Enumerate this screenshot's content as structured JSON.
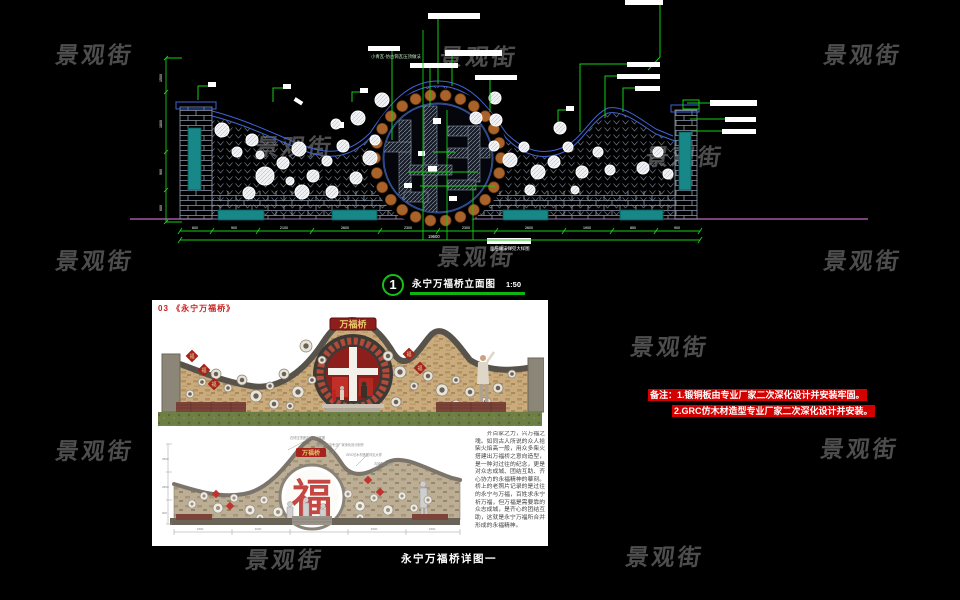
{
  "watermark": {
    "text": "景观街"
  },
  "cad": {
    "annotation_top": "小青瓦-仿古筒瓦压顶做法",
    "annotation_bottom": "面层做法详见大样图",
    "dim_overall": "19600",
    "dims_bottom": [
      "600",
      "900",
      "2100",
      "2600",
      "2300",
      "2300",
      "2600",
      "1900",
      "850",
      "900"
    ],
    "dims_left": [
      "1500",
      "1800",
      "900",
      "600"
    ]
  },
  "drawing_title": {
    "number": "1",
    "label": "永宁万福桥立面图",
    "scale": "1:50"
  },
  "panel": {
    "title": "03 《永宁万福桥》",
    "plaque": "万福桥",
    "fu": "福",
    "paragraph": "齐百家之力，兴万福之魂。如同古人所说的众人拾柴火焰高一般，用众多柴火搭建出万福桥之意向造型，是一种对过往的纪念，更是对众志成城、团结互助、齐心协力的永福精神的摹刻。桥上的老照片记录的是过往的永宁与万福，百姓求永宁祈万福，但万福是需要靠的众志成城，是齐心的团结互助，这就是永宁万福所合并形成的永福精神。",
    "detail_annotations": [
      "石材压顶做法详见大样图",
      "锻铜浮雕由专业厂家深化设计制作",
      "GRC仿木材造型详见大样",
      "青砖贴面做法"
    ],
    "detail_dims_left": [
      "3500",
      "2800",
      "900"
    ],
    "detail_dims_bottom": [
      "1800",
      "3600",
      "4800",
      "3600",
      "1800"
    ]
  },
  "notes": {
    "line1": "备注：1.锻铜板由专业厂家二次深化设计并安装牢固。",
    "line2": "2.GRC仿木材造型专业厂家二次深化设计并安装。"
  },
  "bottom_caption": "永宁万福桥详图一",
  "colors": {
    "dim_green": "#15cf15",
    "coping_blue": "#3f63d4",
    "teal": "#178787",
    "ring_orange": "#a9622a",
    "ground_magenta": "#c26ac2",
    "note_red": "#d40000",
    "title_red": "#cc2020"
  }
}
